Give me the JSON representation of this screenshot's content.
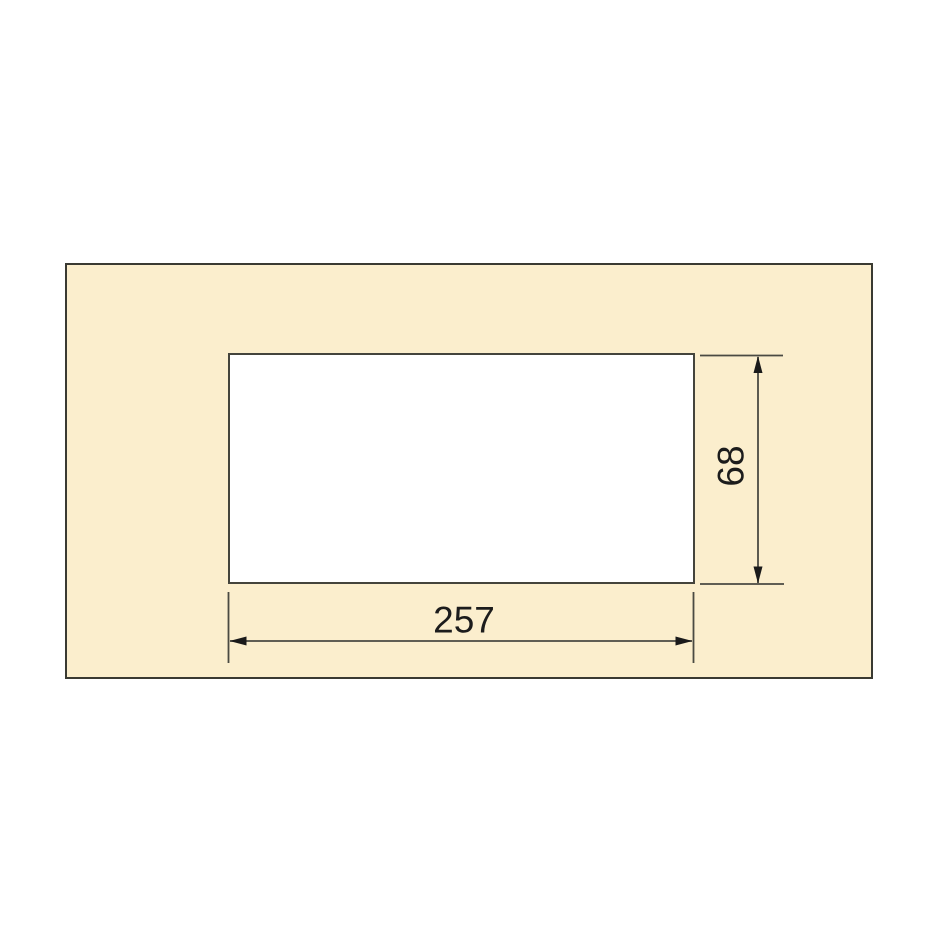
{
  "drawing": {
    "title": "panel cutout dimension drawing",
    "dimensions": {
      "width_label": "257",
      "height_label": "68"
    },
    "colors": {
      "background": "#FFFFFF",
      "panel_fill": "#FBEECD",
      "cutout_fill": "#FFFFFF",
      "outline": "#3A3A32",
      "dimension_line": "#4A4A42",
      "arrow": "#1A1A1A",
      "text": "#1C1C1C"
    }
  }
}
